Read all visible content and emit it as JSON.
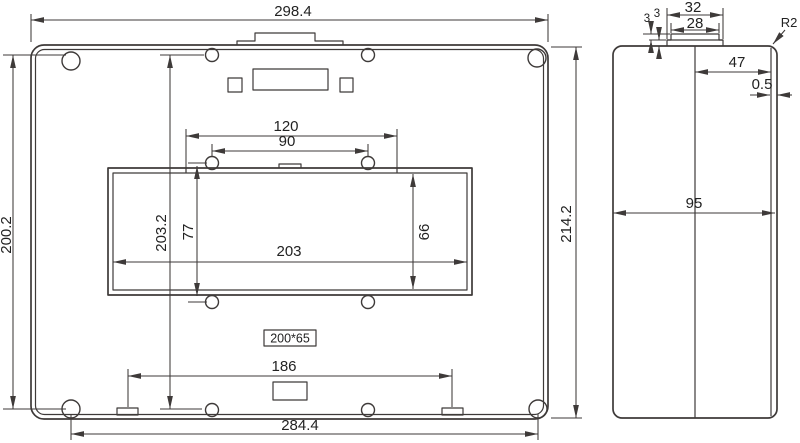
{
  "title": "enclosure-dimension-drawing",
  "front_view": {
    "overall_width": "298.4",
    "corner_hole_span_vertical": "200.2",
    "overall_height": "214.2",
    "corner_hole_span_horizontal": "284.4",
    "cutout_step_span": "120",
    "boss_hole_span_horizontal": "90",
    "cutout_width": "203",
    "boss_hole_span_vertical_outer": "203.2",
    "boss_hole_span_vertical_inner": "77",
    "cutout_height": "66",
    "bottom_tab_span": "186",
    "panel_label": "200*65"
  },
  "side_view": {
    "tab_outer_width": "32",
    "tab_inner_width": "28",
    "tab_step_height_upper": "3",
    "tab_step_height_lower": "3",
    "corner_radius": "R2",
    "tab_to_front_distance": "47",
    "front_lip": "0.5",
    "body_depth": "95"
  },
  "colors": {
    "line": "#3e3a39",
    "text": "#222222",
    "background": "#ffffff"
  }
}
